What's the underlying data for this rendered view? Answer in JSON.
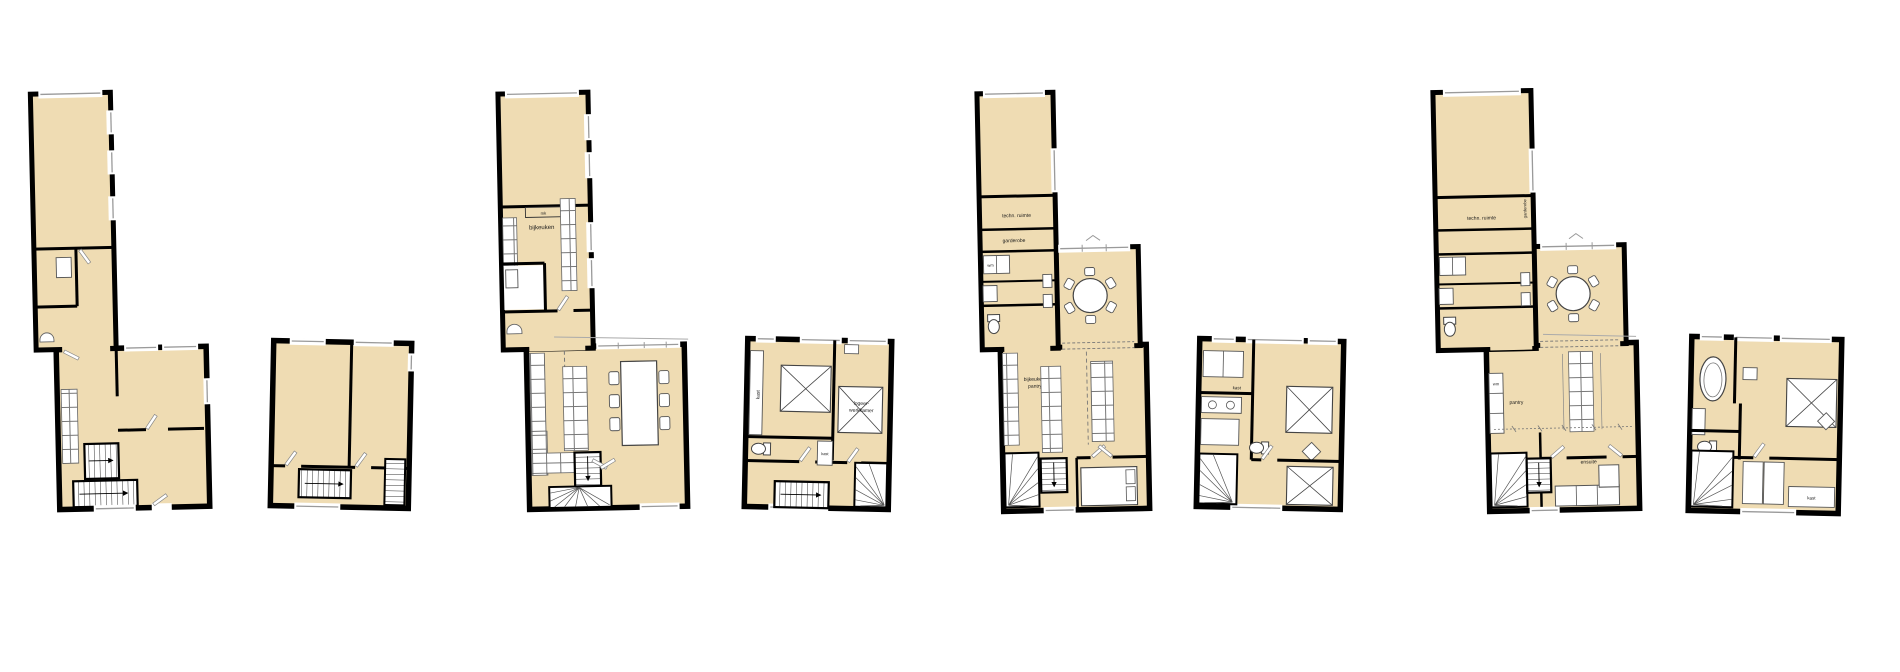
{
  "document": {
    "kind": "architectural-floor-plans",
    "sheet_background": "#ffffff"
  },
  "palette": {
    "floor_fill": "#efdcb3",
    "wall": "#000000",
    "fixture_line": "#4a4a4a",
    "window_line": "#9a9a9a"
  },
  "plans": [
    {
      "id": "plan-a-ground",
      "labels": {}
    },
    {
      "id": "plan-a-first",
      "labels": {}
    },
    {
      "id": "plan-b-ground",
      "labels": {
        "mk": "mk",
        "bijkeuken": "bijkeuken"
      }
    },
    {
      "id": "plan-b-first",
      "labels": {
        "kast_left": "kast",
        "logeer_line1": "logeer-",
        "logeer_line2": "werkkamer",
        "kast_mid": "kast"
      }
    },
    {
      "id": "plan-c-ground",
      "labels": {
        "techn_ruimte": "techn. ruimte",
        "garderobe": "garderobe",
        "wm": "wm",
        "bijkeuken_line1": "bijkeuken/",
        "bijkeuken_line2": "pantry"
      }
    },
    {
      "id": "plan-c-first",
      "labels": {
        "kast_top": "kast",
        "kast_shelf": "kast"
      }
    },
    {
      "id": "plan-d-ground",
      "labels": {
        "techn_ruimte": "techn. ruimte",
        "garderobe": "garderobe",
        "wm": "wm",
        "pantry": "pantry",
        "ensuite": "ensuite"
      }
    },
    {
      "id": "plan-d-first",
      "labels": {
        "kast": "kast"
      }
    }
  ]
}
